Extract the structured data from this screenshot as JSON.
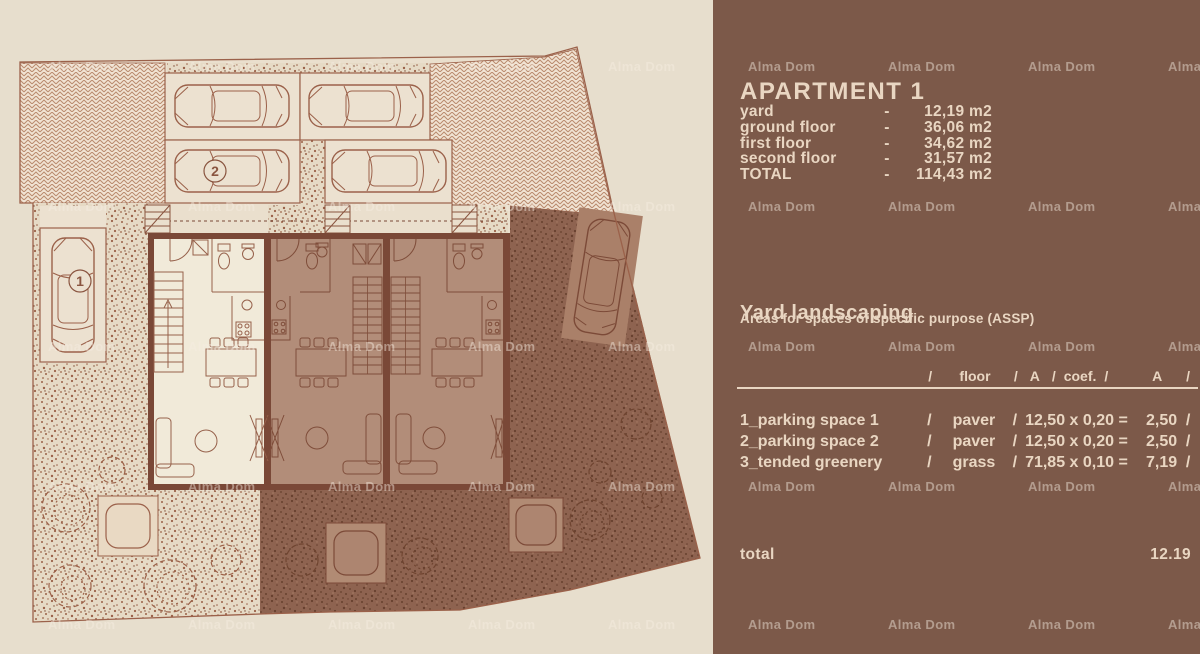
{
  "watermark": "Alma Dom",
  "panel": {
    "title": "APARTMENT 1",
    "areas_dash": "-",
    "areas": [
      {
        "label": "yard",
        "value": "12,19 m2"
      },
      {
        "label": "ground floor",
        "value": "36,06 m2"
      },
      {
        "label": "first floor",
        "value": "34,62 m2"
      },
      {
        "label": "second floor",
        "value": "31,57 m2"
      },
      {
        "label": "TOTAL",
        "value": "114,43 m2"
      }
    ],
    "landscaping": {
      "title": "Yard landscaping",
      "subtitle": "Areas for spaces of specific purpose (ASSP)",
      "sep": "/",
      "header": {
        "floor": "floor",
        "a": "A",
        "coef": "coef.",
        "a2": "A"
      },
      "rows": [
        {
          "name": "1_parking space 1",
          "floor": "paver",
          "calc": "12,50 x 0,20 =",
          "result": "2,50"
        },
        {
          "name": "2_parking space 2",
          "floor": "paver",
          "calc": "12,50 x 0,20 =",
          "result": "2,50"
        },
        {
          "name": "3_tended greenery",
          "floor": "grass",
          "calc": "71,85 x 0,10 =",
          "result": "7,19"
        }
      ],
      "total_label": "total",
      "total_value": "12.19"
    }
  },
  "plan": {
    "space1_label": "1",
    "space2_label": "2"
  },
  "colors": {
    "background": "#e7decd",
    "panel_background": "#7c5949",
    "panel_text": "#e9d6c2",
    "plan_line": "#9b614a",
    "wall": "#7a4837",
    "shaded_unit": "#b28d79",
    "light_unit": "#f1ead9",
    "dark_yard": "#8e6350"
  }
}
